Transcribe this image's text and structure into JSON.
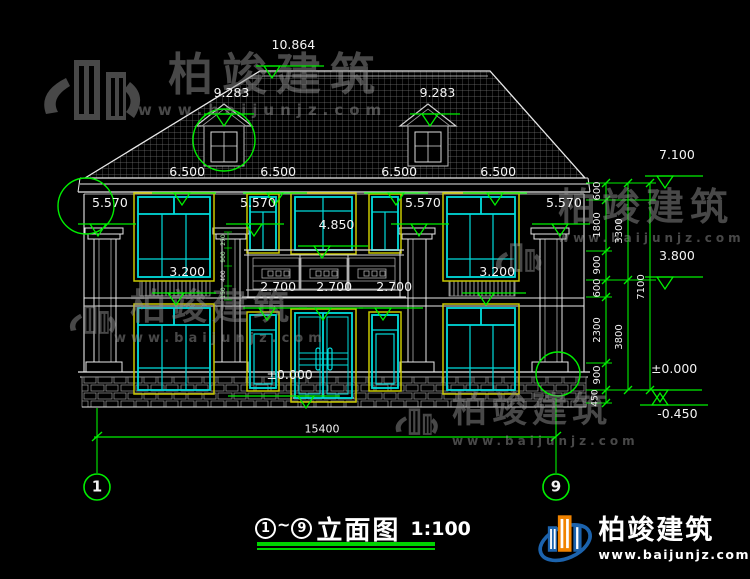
{
  "drawing": {
    "colors": {
      "background": "#000000",
      "line_white": "#e8e8e8",
      "window_cyan": "#00dcdc",
      "frame_yellow": "#c8c800",
      "dim_green": "#00ef00",
      "watermark_gray": "#8f8f8f",
      "brand_blue": "#1c63ad",
      "brand_orange": "#f08300"
    },
    "markers": [
      {
        "t": "10.864",
        "x": 256,
        "y": 66,
        "w": 68,
        "o": 8
      },
      {
        "t": "9.283",
        "x": 204,
        "y": 114,
        "w": 50,
        "o": 12
      },
      {
        "t": "9.283",
        "x": 410,
        "y": 114,
        "w": 50,
        "o": 12
      },
      {
        "t": "6.500",
        "x": 152,
        "y": 193,
        "w": 64,
        "o": 22
      },
      {
        "t": "6.500",
        "x": 243,
        "y": 193,
        "w": 64,
        "o": 24
      },
      {
        "t": "6.500",
        "x": 364,
        "y": 193,
        "w": 64,
        "o": 24
      },
      {
        "t": "6.500",
        "x": 463,
        "y": 193,
        "w": 64,
        "o": 24
      },
      {
        "t": "5.570",
        "x": 78,
        "y": 224,
        "w": 58,
        "o": 12
      },
      {
        "t": "5.570",
        "x": 226,
        "y": 224,
        "w": 58,
        "o": 20
      },
      {
        "t": "5.570",
        "x": 391,
        "y": 224,
        "w": 58,
        "o": 20
      },
      {
        "t": "5.570",
        "x": 532,
        "y": 224,
        "w": 58,
        "o": 20
      },
      {
        "t": "4.850",
        "x": 298,
        "y": 246,
        "w": 70,
        "o": 16
      },
      {
        "t": "3.200",
        "x": 152,
        "y": 293,
        "w": 64,
        "o": 16
      },
      {
        "t": "3.200",
        "x": 462,
        "y": 293,
        "w": 64,
        "o": 16
      },
      {
        "t": "2.700",
        "x": 243,
        "y": 308,
        "w": 64,
        "o": 16
      },
      {
        "t": "2.700",
        "x": 299,
        "y": 308,
        "w": 64,
        "o": 16
      },
      {
        "t": "2.700",
        "x": 359,
        "y": 308,
        "w": 64,
        "o": 16
      },
      {
        "t": "±0.000",
        "x": 228,
        "y": 396,
        "w": 112,
        "o": 70
      },
      {
        "t": "7.100",
        "x": 645,
        "y": 176,
        "w": 58,
        "o": 12
      },
      {
        "t": "3.800",
        "x": 645,
        "y": 277,
        "w": 58,
        "o": 12
      },
      {
        "t": "±0.000",
        "x": 640,
        "y": 390,
        "w": 62,
        "o": 12
      },
      {
        "t": "-0.450",
        "x": 640,
        "y": 403,
        "w": 68,
        "o": 12,
        "flip": 1
      }
    ],
    "labels": [
      {
        "t": "600",
        "x": 598,
        "y": 191,
        "rot": -90,
        "s": 10
      },
      {
        "t": "1800",
        "x": 598,
        "y": 225,
        "rot": -90,
        "s": 10
      },
      {
        "t": "900",
        "x": 598,
        "y": 265,
        "rot": -90,
        "s": 10
      },
      {
        "t": "600",
        "x": 598,
        "y": 288,
        "rot": -90,
        "s": 10
      },
      {
        "t": "2300",
        "x": 598,
        "y": 330,
        "rot": -90,
        "s": 10
      },
      {
        "t": "900",
        "x": 598,
        "y": 375,
        "rot": -90,
        "s": 10
      },
      {
        "t": "450",
        "x": 596,
        "y": 398,
        "rot": -90,
        "s": 9
      },
      {
        "t": "3300",
        "x": 620,
        "y": 231,
        "rot": -90,
        "s": 10
      },
      {
        "t": "3800",
        "x": 620,
        "y": 337,
        "rot": -90,
        "s": 10
      },
      {
        "t": "7100",
        "x": 642,
        "y": 287,
        "rot": -90,
        "s": 10
      },
      {
        "t": "15400",
        "x": 322,
        "y": 429,
        "s": 11
      },
      {
        "t": "270",
        "x": 224,
        "y": 240,
        "rot": -90,
        "s": 6,
        "c": "#a8f0a8"
      },
      {
        "t": "900",
        "x": 224,
        "y": 257,
        "rot": -90,
        "s": 6,
        "c": "#a8f0a8"
      },
      {
        "t": "400",
        "x": 224,
        "y": 276,
        "rot": -90,
        "s": 6,
        "c": "#e8e8e8"
      },
      {
        "t": "150",
        "x": 224,
        "y": 293,
        "rot": -90,
        "s": 6,
        "c": "#a8f0a8"
      },
      {
        "t": "1",
        "x": 97,
        "y": 487,
        "s": 15,
        "wt": 700
      },
      {
        "t": "9",
        "x": 556,
        "y": 487,
        "s": 15,
        "wt": 700
      }
    ],
    "title": {
      "axis_start": "1",
      "tilde": "~",
      "axis_end": "9",
      "name": "立面图",
      "scale": "1:100"
    },
    "watermark": {
      "name": "柏竣建筑",
      "url": "www.baijunjz.com"
    },
    "brand": {
      "name": "柏竣建筑",
      "url": "www.baijunjz.com"
    }
  }
}
